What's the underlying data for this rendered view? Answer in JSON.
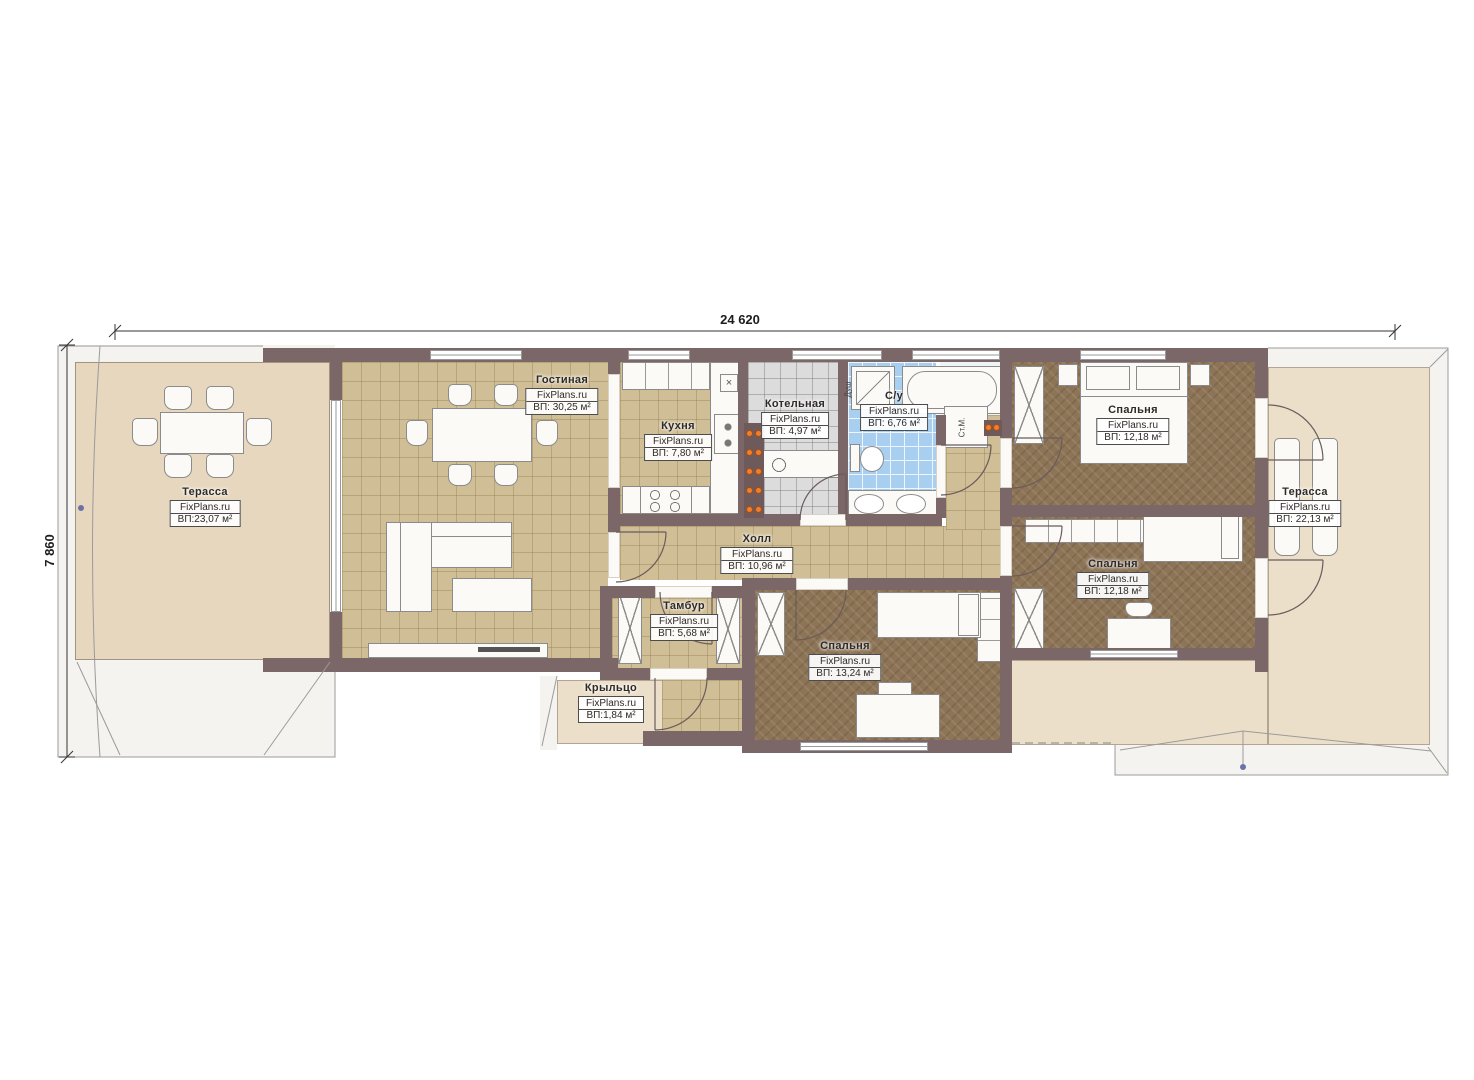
{
  "site_watermark": "FixPlans.ru",
  "dimensions": {
    "width_total": "24 620",
    "height_total": "7 860"
  },
  "rooms": [
    {
      "id": "terrace-left",
      "name": "Терасса",
      "site": "FixPlans.ru",
      "area": "ВП:23,07 м²"
    },
    {
      "id": "living",
      "name": "Гостиная",
      "site": "FixPlans.ru",
      "area": "ВП: 30,25 м²"
    },
    {
      "id": "kitchen",
      "name": "Кухня",
      "site": "FixPlans.ru",
      "area": "ВП: 7,80 м²"
    },
    {
      "id": "boiler",
      "name": "Котельная",
      "site": "FixPlans.ru",
      "area": "ВП: 4,97 м²"
    },
    {
      "id": "bath",
      "name": "С/у",
      "site": "FixPlans.ru",
      "area": "ВП: 6,76 м²"
    },
    {
      "id": "hall",
      "name": "Холл",
      "site": "FixPlans.ru",
      "area": "ВП: 10,96 м²"
    },
    {
      "id": "tambur",
      "name": "Тамбур",
      "site": "FixPlans.ru",
      "area": "ВП: 5,68 м²"
    },
    {
      "id": "porch",
      "name": "Крыльцо",
      "site": "FixPlans.ru",
      "area": "ВП:1,84 м²"
    },
    {
      "id": "bedroom-top",
      "name": "Спальня",
      "site": "FixPlans.ru",
      "area": "ВП: 12,18 м²"
    },
    {
      "id": "bedroom-mid",
      "name": "Спальня",
      "site": "FixPlans.ru",
      "area": "ВП: 12,18 м²"
    },
    {
      "id": "bedroom-bottom",
      "name": "Спальня",
      "site": "FixPlans.ru",
      "area": "ВП: 13,24 м²"
    },
    {
      "id": "terrace-right",
      "name": "Терасса",
      "site": "FixPlans.ru",
      "area": "ВП: 22,13 м²"
    }
  ],
  "annotations": {
    "washer": "Ст.М.",
    "shower": "Душ"
  },
  "colors": {
    "wall": "#7b6767",
    "floor_tile": "#cfbe96",
    "bedroom_floor": "#8d7456",
    "bath_tile": "#a9cff0",
    "boiler_tile": "#dcdcdc",
    "terrace_left": "#e6d7be",
    "terrace_right": "#ebdfc9",
    "heat_dot": "#ef7e2e"
  }
}
